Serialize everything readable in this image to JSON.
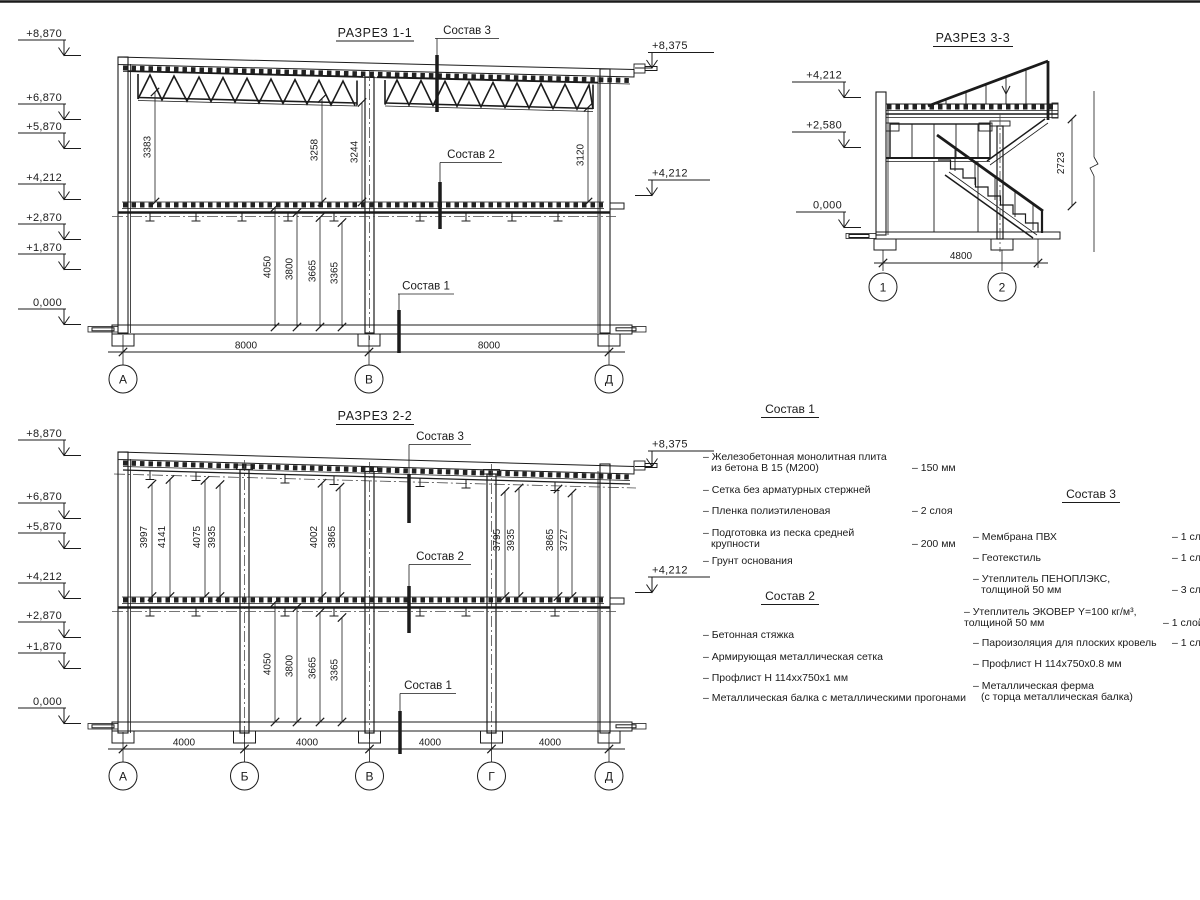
{
  "colors": {
    "ink": "#1b1b1b",
    "paper": "#ffffff"
  },
  "sections": {
    "s11": {
      "title": "РАЗРЕЗ 1-1",
      "marks_left": [
        "+8,870",
        "+6,870",
        "+5,870",
        "+4,212",
        "+2,870",
        "+1,870",
        "0,000"
      ],
      "marks_right": [
        "+8,375",
        "+4,212"
      ],
      "dims_upper": [
        "3383",
        "3258",
        "3244",
        "3120"
      ],
      "dims_lower": [
        "4050",
        "3800",
        "3665",
        "3365"
      ],
      "dims_bottom": [
        "8000",
        "8000"
      ],
      "axes": [
        "А",
        "В",
        "Д"
      ],
      "callouts": [
        "Состав 3",
        "Состав 2",
        "Состав 1"
      ]
    },
    "s22": {
      "title": "РАЗРЕЗ 2-2",
      "marks_left": [
        "+8,870",
        "+6,870",
        "+5,870",
        "+4,212",
        "+2,870",
        "+1,870",
        "0,000"
      ],
      "marks_right": [
        "+8,375",
        "+4,212"
      ],
      "dims_upper": [
        "3997",
        "4141",
        "4075",
        "3935",
        "4002",
        "3865",
        "3795",
        "3935",
        "3865",
        "3727"
      ],
      "dims_lower": [
        "4050",
        "3800",
        "3665",
        "3365"
      ],
      "dims_bottom": [
        "4000",
        "4000",
        "4000",
        "4000"
      ],
      "axes": [
        "А",
        "Б",
        "В",
        "Г",
        "Д"
      ],
      "callouts": [
        "Состав 3",
        "Состав 2",
        "Состав 1"
      ]
    },
    "s33": {
      "title": "РАЗРЕЗ 3-3",
      "marks_left": [
        "+4,212",
        "+2,580",
        "0,000"
      ],
      "dim_vertical": "2723",
      "dim_bottom": "4800",
      "axes": [
        "1",
        "2"
      ]
    }
  },
  "specs": {
    "s1": {
      "title": "Состав 1",
      "rows": [
        {
          "t1": "– Железобетонная  монолитная плита",
          "t2": "из бетона В 15 (М200)",
          "val": "– 150 мм"
        },
        {
          "t1": "– Сетка без арматурных стержней"
        },
        {
          "t1": "– Пленка полиэтиленовая",
          "val": "– 2 слоя"
        },
        {
          "t1": "– Подготовка из песка средней",
          "t2": "крупности",
          "val": "– 200 мм"
        },
        {
          "t1": "– Грунт основания"
        }
      ]
    },
    "s2": {
      "title": "Состав 2",
      "rows": [
        {
          "t1": "– Бетонная стяжка"
        },
        {
          "t1": "– Армирующая металлическая сетка"
        },
        {
          "t1": "– Профлист Н 114хх750х1 мм"
        },
        {
          "t1": "– Металлическая балка с металлическими прогонами"
        }
      ]
    },
    "s3": {
      "title": "Состав 3",
      "rows": [
        {
          "t1": "– Мембрана ПВХ",
          "val": "– 1 слой"
        },
        {
          "t1": "– Геотекстиль",
          "val": "– 1 слой"
        },
        {
          "t1": "– Утеплитель ПЕНОПЛЭКС,",
          "t2": "толщиной 50 мм",
          "val": "– 3 слоя"
        },
        {
          "t1": "– Утеплитель ЭКОВЕР Y=100 кг/м³,",
          "t2": "толщиной 50 мм",
          "val": "– 1 слой"
        },
        {
          "t1": "– Пароизоляция для плоских кровель",
          "val": "– 1 слой"
        },
        {
          "t1": "– Профлист Н 114х750х0.8 мм"
        },
        {
          "t1": "– Металлическая ферма",
          "t2": "(с торца металлическая балка)"
        }
      ]
    }
  }
}
